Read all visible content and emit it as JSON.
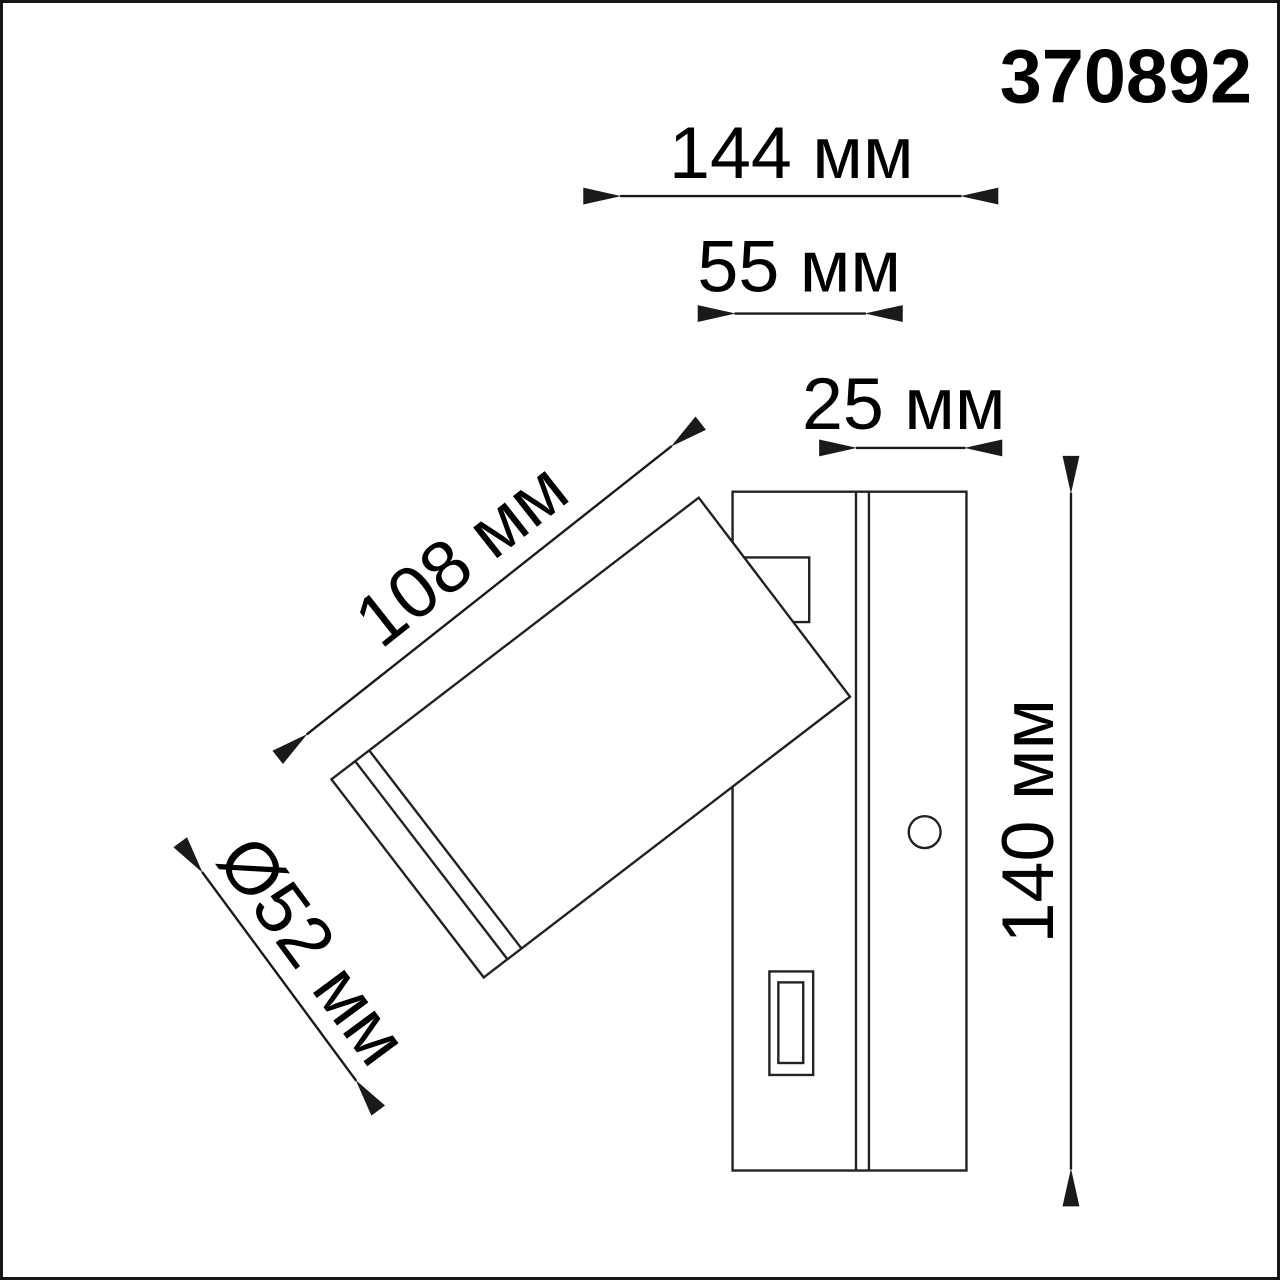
{
  "part_number": "370892",
  "dimensions": {
    "total_width": "144 мм",
    "arm_depth": "55 мм",
    "plate_depth": "25 мм",
    "head_length": "108 мм",
    "head_diameter": "Ø52 мм",
    "height": "140 мм"
  },
  "drawing": {
    "type": "technical-dimension-drawing",
    "subject": "wall-mounted adjustable spotlight, side view",
    "features": [
      "wall-plate",
      "mounting-arm",
      "tilted-cylindrical-head",
      "lens-bezel-rings",
      "pivot-bracket",
      "screw-hole",
      "switch"
    ]
  },
  "colors": {
    "background": "#ffffff",
    "line": "#222222",
    "text": "#000000",
    "border": "#161616"
  }
}
